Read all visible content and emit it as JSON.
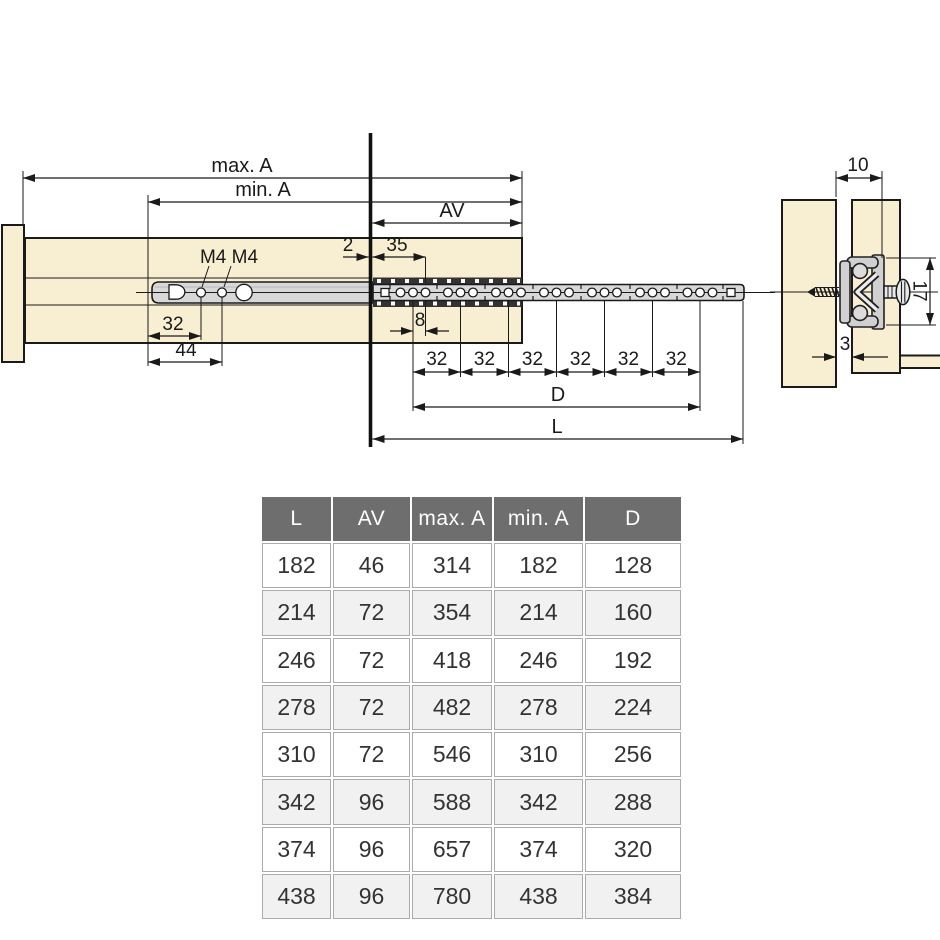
{
  "plan_view": {
    "labels": {
      "max_a": "max. A",
      "min_a": "min. A",
      "av": "AV",
      "front_gap": "2",
      "d35": "35",
      "m4": "M4 M4",
      "d32_left": "32",
      "d44": "44",
      "d8": "8",
      "s32": "32",
      "d": "D",
      "l": "L"
    }
  },
  "section_view": {
    "labels": {
      "d10": "10",
      "d17": "17",
      "d3": "3"
    }
  },
  "table": {
    "headers": [
      "L",
      "AV",
      "max. A",
      "min. A",
      "D"
    ],
    "rows": [
      [
        "182",
        "46",
        "314",
        "182",
        "128"
      ],
      [
        "214",
        "72",
        "354",
        "214",
        "160"
      ],
      [
        "246",
        "72",
        "418",
        "246",
        "192"
      ],
      [
        "278",
        "72",
        "482",
        "278",
        "224"
      ],
      [
        "310",
        "72",
        "546",
        "310",
        "256"
      ],
      [
        "342",
        "96",
        "588",
        "342",
        "288"
      ],
      [
        "374",
        "96",
        "657",
        "374",
        "320"
      ],
      [
        "438",
        "96",
        "780",
        "438",
        "384"
      ]
    ]
  },
  "colors": {
    "wood": "#f8eed2",
    "rail": "#d8d8d8",
    "line": "#1a1a1a",
    "strip": "#333333",
    "table_header_bg": "#6e6e6e",
    "table_alt_row": "#f1f1f1",
    "table_text": "#333333"
  }
}
